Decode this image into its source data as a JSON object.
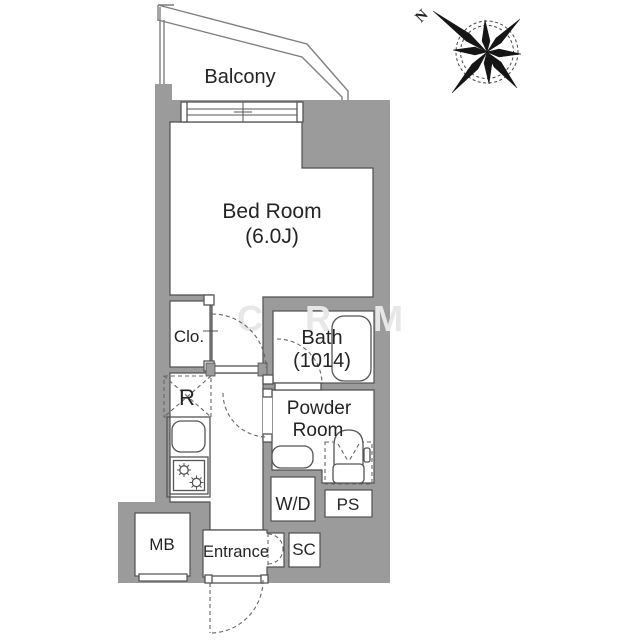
{
  "colors": {
    "wall": "#9b9b9b",
    "wall-stroke": "#4f4f4f",
    "line": "#555555",
    "dash": "#666666",
    "text": "#242424",
    "watermark": "#e7e7e7",
    "bg": "#ffffff",
    "balcony-line": "#7f7f7f"
  },
  "compass": {
    "north_label": "N"
  },
  "labels": {
    "balcony": "Balcony",
    "bedroom": "Bed Room",
    "bedroom_size": "(6.0J)",
    "closet": "Clo.",
    "bath": "Bath",
    "bath_size": "(1014)",
    "powder_line1": "Powder",
    "powder_line2": "Room",
    "refrigerator": "R",
    "washer_dryer": "W/D",
    "pipe_shaft": "PS",
    "meter_box": "MB",
    "entrance": "Entrance",
    "shoe_cabinet": "SC"
  },
  "watermark": {
    "c1": "C",
    "c2": "R",
    "c3": "M"
  }
}
